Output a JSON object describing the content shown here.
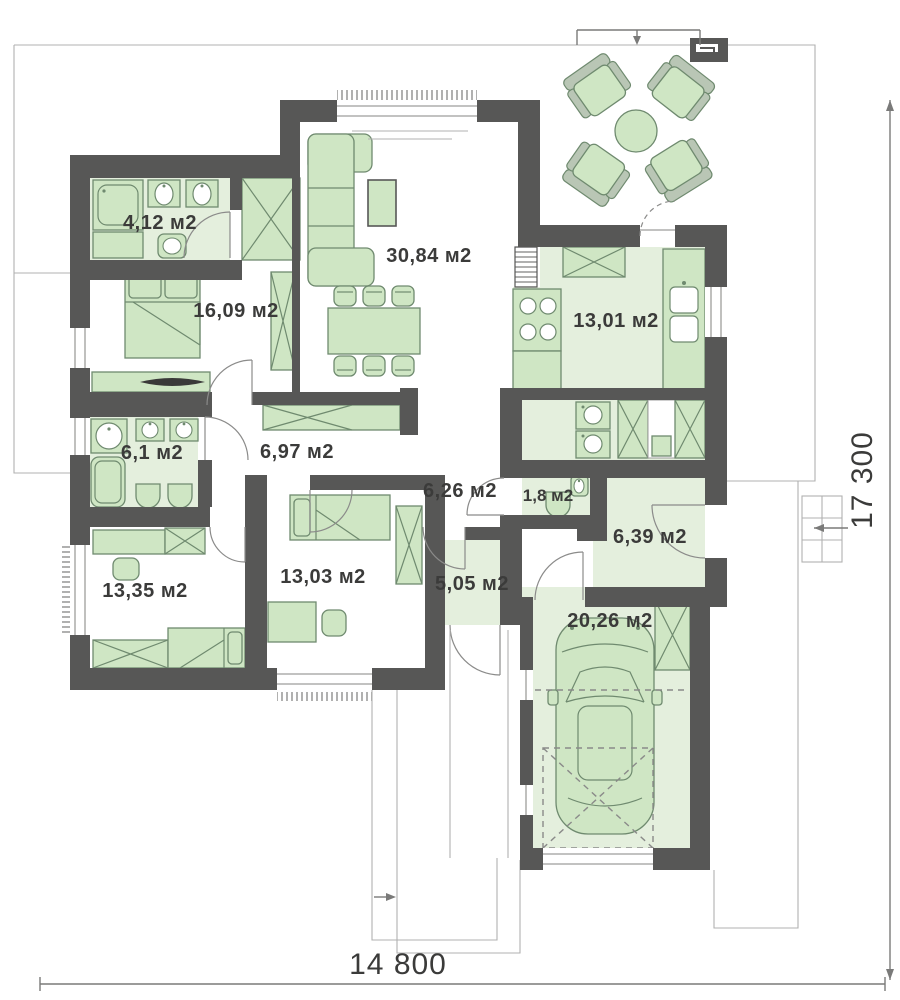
{
  "rooms": [
    {
      "id": "bathroom-1",
      "area": "4,12 м2"
    },
    {
      "id": "bedroom-main",
      "area": "16,09 м2"
    },
    {
      "id": "living-room",
      "area": "30,84 м2"
    },
    {
      "id": "kitchen",
      "area": "13,01 м2"
    },
    {
      "id": "bathroom-2",
      "area": "6,1 м2"
    },
    {
      "id": "hallway",
      "area": "6,97 м2"
    },
    {
      "id": "corridor",
      "area": "6,26 м2"
    },
    {
      "id": "wc",
      "area": "1,8 м2"
    },
    {
      "id": "entrance-hall",
      "area": "6,39 м2"
    },
    {
      "id": "bedroom-child-1",
      "area": "13,35 м2"
    },
    {
      "id": "bedroom-child-2",
      "area": "13,03 м2"
    },
    {
      "id": "mudroom",
      "area": "5,05 м2"
    },
    {
      "id": "garage",
      "area": "20,26 м2"
    }
  ],
  "dimensions": {
    "overall_width": "14 800",
    "overall_height": "17 300"
  },
  "colors": {
    "wall": "#575756",
    "room_fill": "#e4efdd",
    "furniture_fill": "#cfe6c4",
    "furniture_stroke": "#6f8a6f",
    "outline": "#9d9d9c",
    "text": "#3b3b3a"
  }
}
